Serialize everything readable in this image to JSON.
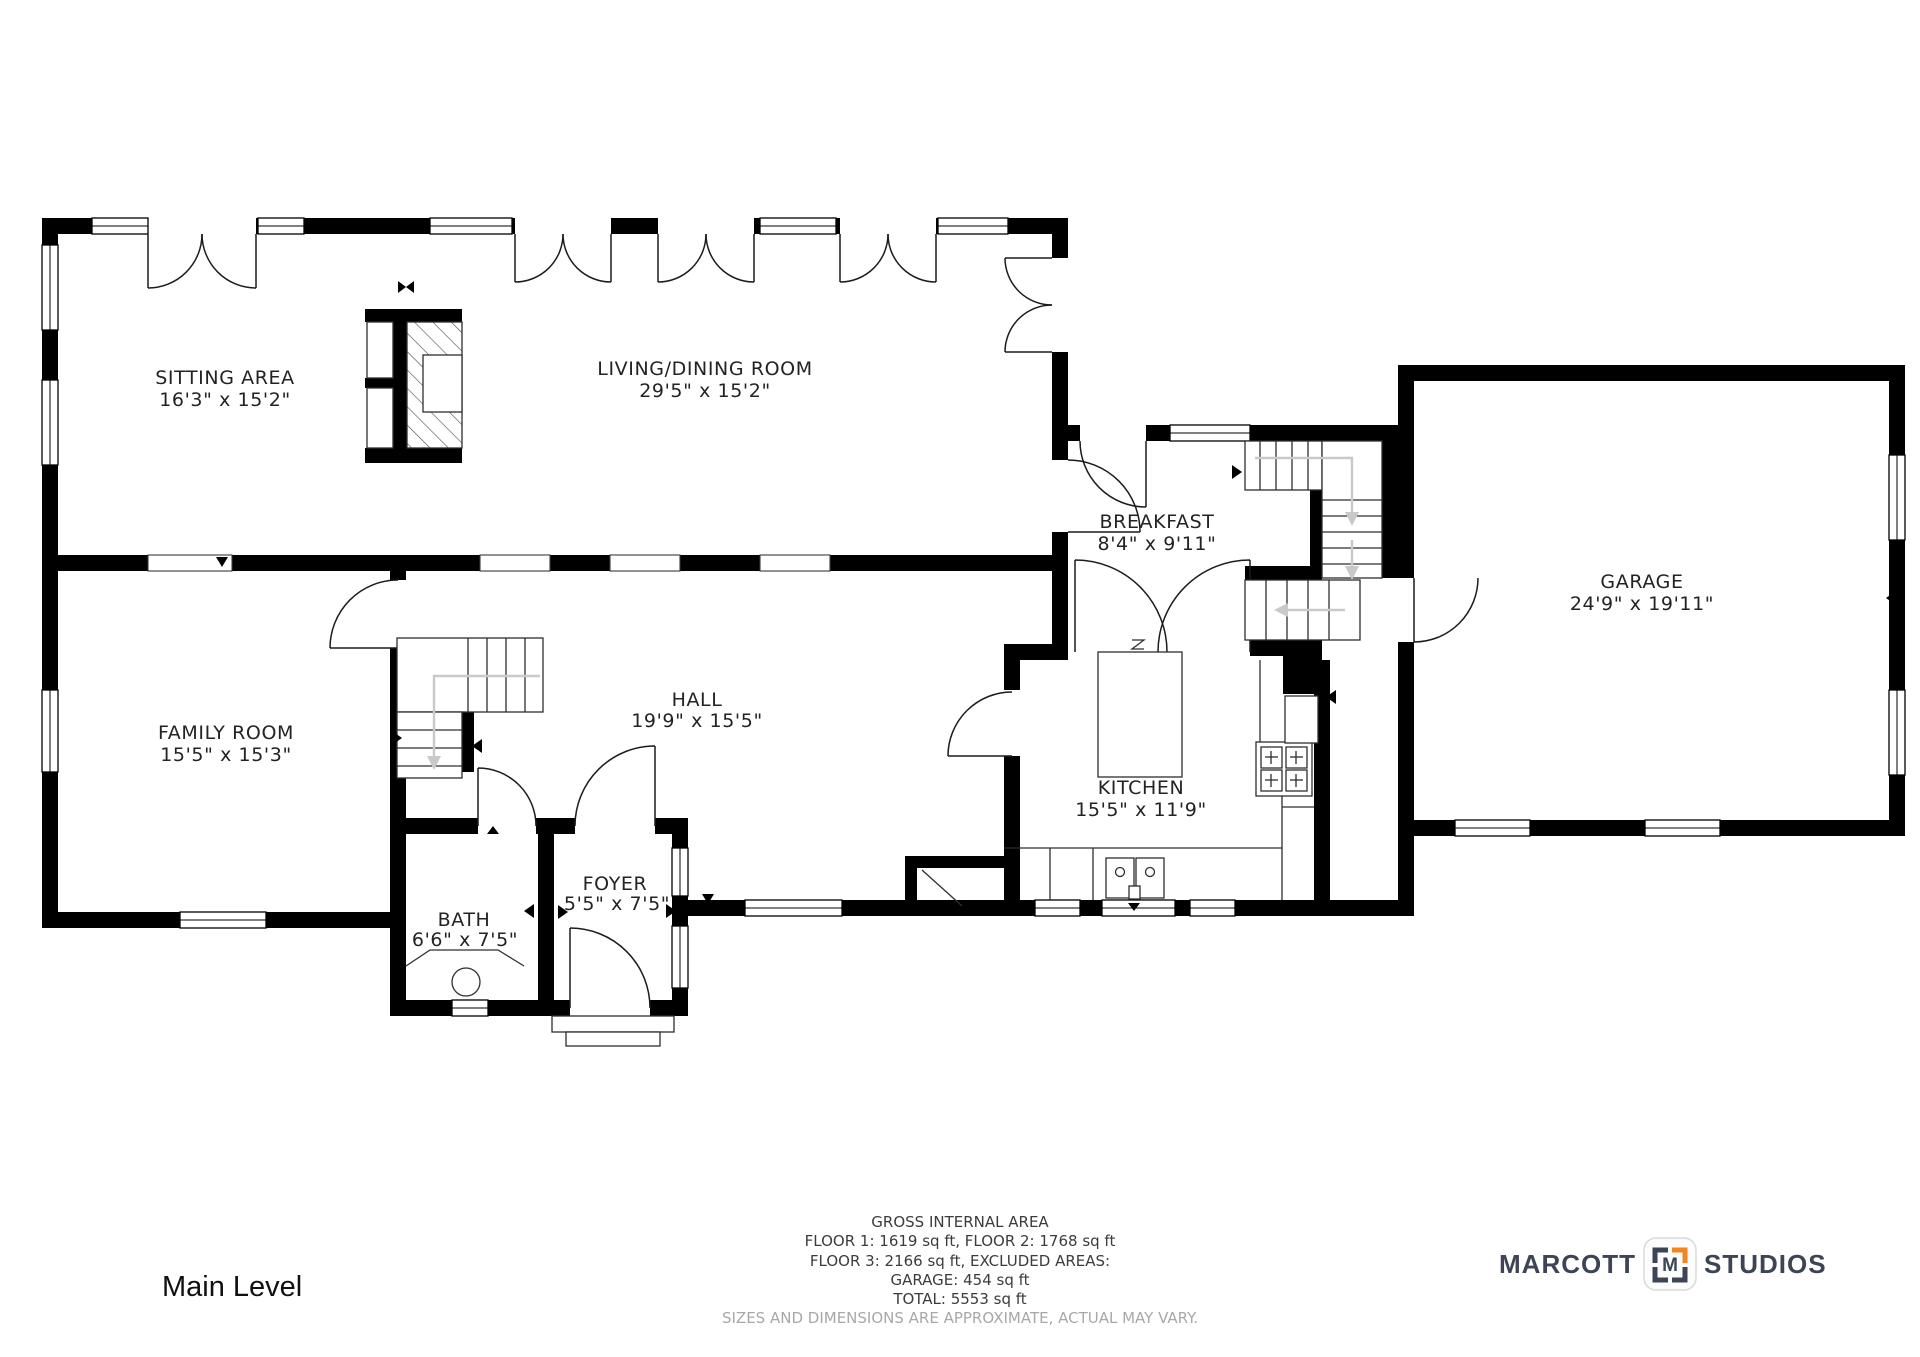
{
  "title": "Main Level",
  "rooms": {
    "sitting_area": {
      "name": "SITTING AREA",
      "dims": "16'3\" x 15'2\""
    },
    "living_dining": {
      "name": "LIVING/DINING ROOM",
      "dims": "29'5\" x 15'2\""
    },
    "breakfast": {
      "name": "BREAKFAST",
      "dims": "8'4\" x 9'11\""
    },
    "garage": {
      "name": "GARAGE",
      "dims": "24'9\" x 19'11\""
    },
    "family_room": {
      "name": "FAMILY ROOM",
      "dims": "15'5\" x 15'3\""
    },
    "hall": {
      "name": "HALL",
      "dims": "19'9\" x 15'5\""
    },
    "kitchen": {
      "name": "KITCHEN",
      "dims": "15'5\" x 11'9\""
    },
    "bath": {
      "name": "BATH",
      "dims": "6'6\" x 7'5\""
    },
    "foyer": {
      "name": "FOYER",
      "dims": "5'5\" x 7'5\""
    }
  },
  "area_summary": {
    "line1": "GROSS INTERNAL AREA",
    "line2": "FLOOR 1: 1619 sq ft, FLOOR 2: 1768 sq ft",
    "line3": "FLOOR 3: 2166 sq ft, EXCLUDED AREAS:",
    "line4": "GARAGE: 454 sq ft",
    "line5": "TOTAL: 5553 sq ft",
    "disclaimer": "SIZES AND DIMENSIONS ARE APPROXIMATE, ACTUAL MAY VARY."
  },
  "branding": {
    "brand_left": "MARCOTT",
    "brand_right": "STUDIOS",
    "monogram": "M"
  },
  "colors": {
    "wall": "#000000",
    "stair_arrow_gray": "#c9c9c9",
    "brand_navy": "#3d4456",
    "brand_orange": "#f5831f",
    "disclaimer_gray": "#a8a8a8"
  }
}
